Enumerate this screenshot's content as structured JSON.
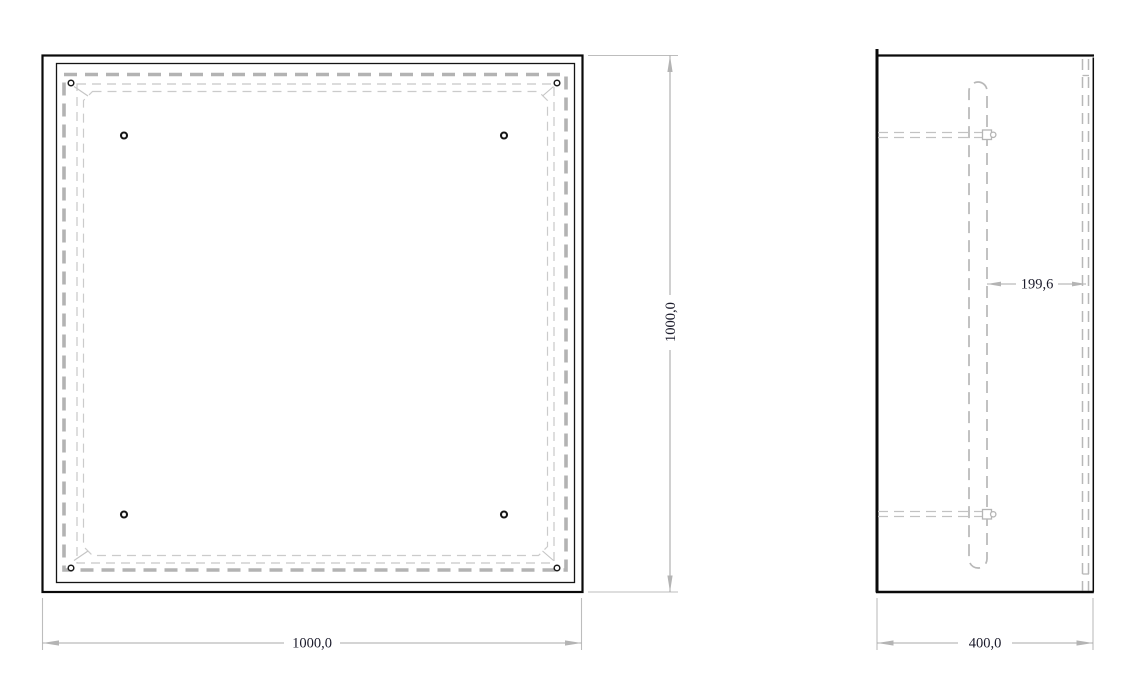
{
  "views": {
    "front": {
      "width_dim": "1000,0",
      "height_dim": "1000,0"
    },
    "side": {
      "depth_dim": "400,0",
      "offset_dim": "199,6"
    }
  },
  "colors": {
    "background": "#ffffff",
    "outline": "#0a0a0a",
    "hidden_line": "#b5b5b5",
    "thin_hidden_line": "#c9c9c9",
    "dimension_line": "#a9a9a9",
    "arrowhead": "#b4b4b4",
    "dimension_text": "#1b1b2b"
  }
}
